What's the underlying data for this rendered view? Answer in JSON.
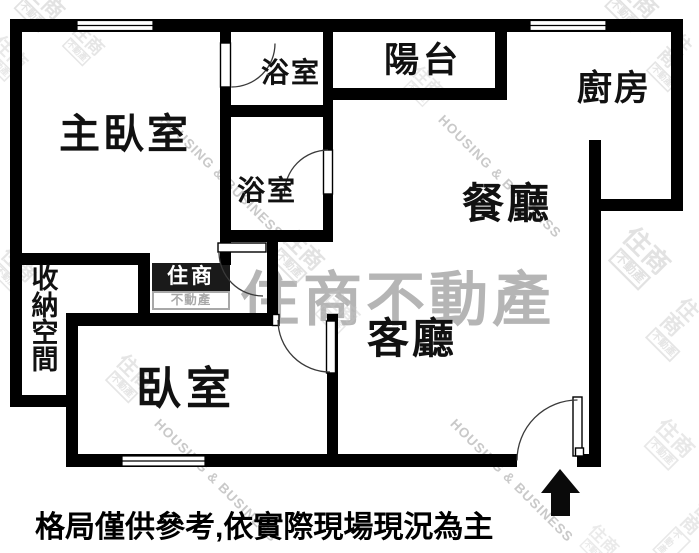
{
  "floorplan": {
    "rooms": {
      "master_bedroom": {
        "label": "主臥室"
      },
      "bathroom_upper": {
        "label": "浴室"
      },
      "bathroom_lower": {
        "label": "浴室"
      },
      "balcony": {
        "label": "陽台"
      },
      "kitchen": {
        "label": "廚房"
      },
      "dining_room": {
        "label": "餐廳"
      },
      "living_room": {
        "label": "客廳"
      },
      "storage": {
        "label": "收納空間"
      },
      "bedroom": {
        "label": "臥室"
      }
    },
    "disclaimer": "格局僅供參考,依實際現場現況為主",
    "colors": {
      "wall": "#000000",
      "background": "#ffffff",
      "label_text": "#111111",
      "watermark_gray": "#b5b5b5",
      "watermark_light": "#c9c9c9"
    }
  },
  "watermark": {
    "brand": "住商不動產",
    "brand_en": "HOUSING & BUSINESS",
    "logo_top": "住商",
    "logo_bottom": "不動產"
  }
}
